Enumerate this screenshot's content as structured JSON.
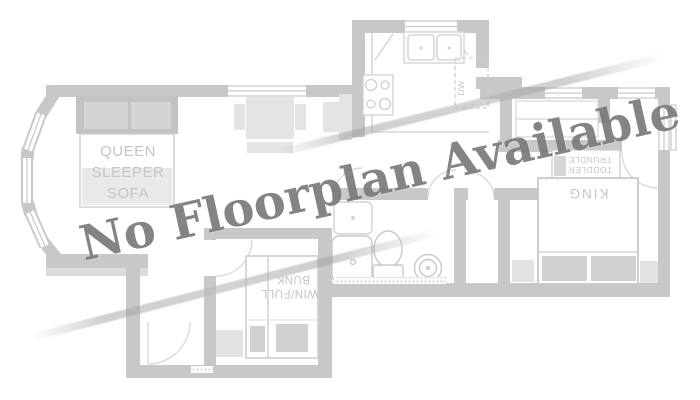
{
  "watermark": {
    "text": "No Floorplan Available",
    "color": "#7a7a7a",
    "angle_deg": -12.6
  },
  "floorplan": {
    "colors": {
      "wall": "#c8c8c8",
      "wall_light": "#dcdcdc",
      "outline": "#cfcfcf",
      "furniture_light": "#e4e4e4",
      "furniture_mid": "#d0d0d0",
      "sofa_back": "#c2c2c2",
      "label": "#c5c5c5",
      "streak": "#ababab"
    },
    "labels": {
      "sofa_line1": "QUEEN",
      "sofa_line2": "SLEEPER",
      "sofa_line3": "SOFA",
      "bunk_line1": "TWIN/FULL",
      "bunk_line2": "BUNK",
      "king": "KING",
      "trundle_line1": "TODDLER",
      "trundle_line2": "TRUNDLE",
      "dishwasher": "DW"
    }
  }
}
